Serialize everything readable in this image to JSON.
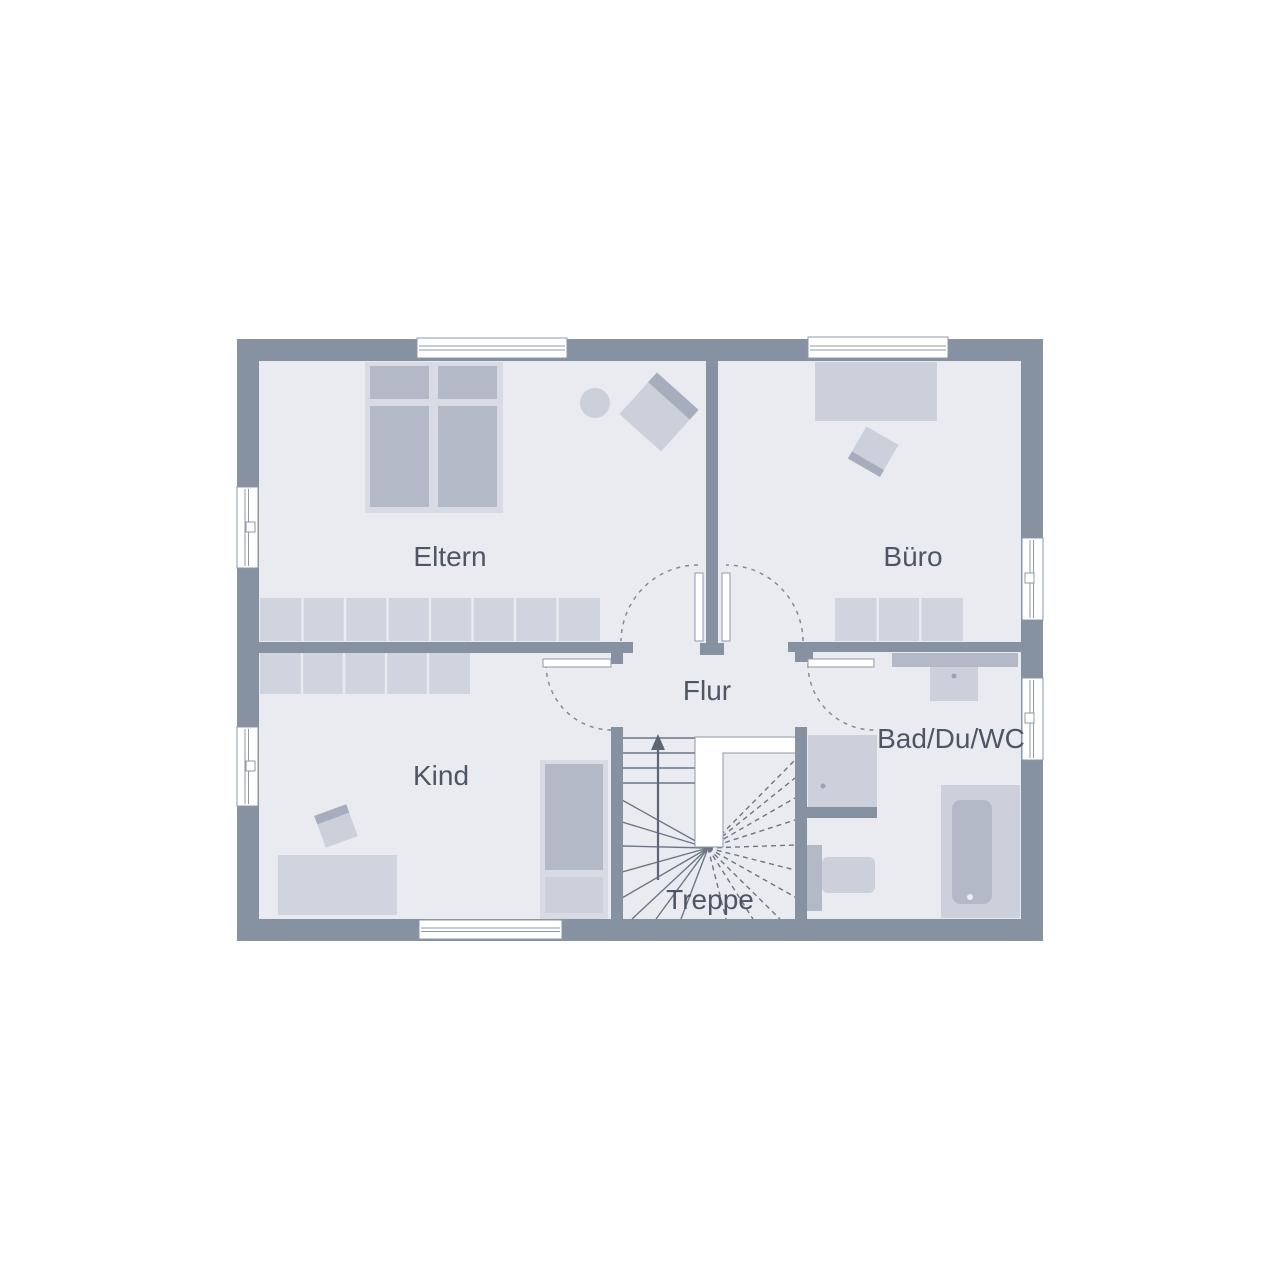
{
  "plan": {
    "type": "floor-plan",
    "rooms": {
      "eltern": {
        "label": "Eltern",
        "furniture": [
          "double-bed",
          "wardrobe",
          "armchair",
          "plant"
        ]
      },
      "buero": {
        "label": "Büro",
        "furniture": [
          "desk",
          "desk-chair",
          "sideboard"
        ]
      },
      "flur": {
        "label": "Flur",
        "furniture": []
      },
      "kind": {
        "label": "Kind",
        "furniture": [
          "bed",
          "wardrobe",
          "desk",
          "desk-chair"
        ]
      },
      "bad": {
        "label": "Bad/Du/WC",
        "furniture": [
          "vanity-counter",
          "washbasin",
          "shower",
          "wc",
          "bathtub"
        ]
      },
      "treppe": {
        "label": "Treppe",
        "stair_direction": "up"
      }
    },
    "counts": {
      "windows": 7,
      "door_leaves": 4
    },
    "colors": {
      "background": "#ffffff",
      "wall": "#8691a2",
      "floor": "#e9ebf1",
      "furniture_frame": "#d8dbe4",
      "furniture_light": "#cfd4de",
      "furniture_mid": "#cbd0db",
      "furniture_dark": "#b3b9c6",
      "chair_back": "#a6adbc",
      "tread_line": "#6d7686",
      "swing_arc": "#828b9b",
      "window_frame": "#8e98a9",
      "label_text": "#4e5665"
    }
  }
}
